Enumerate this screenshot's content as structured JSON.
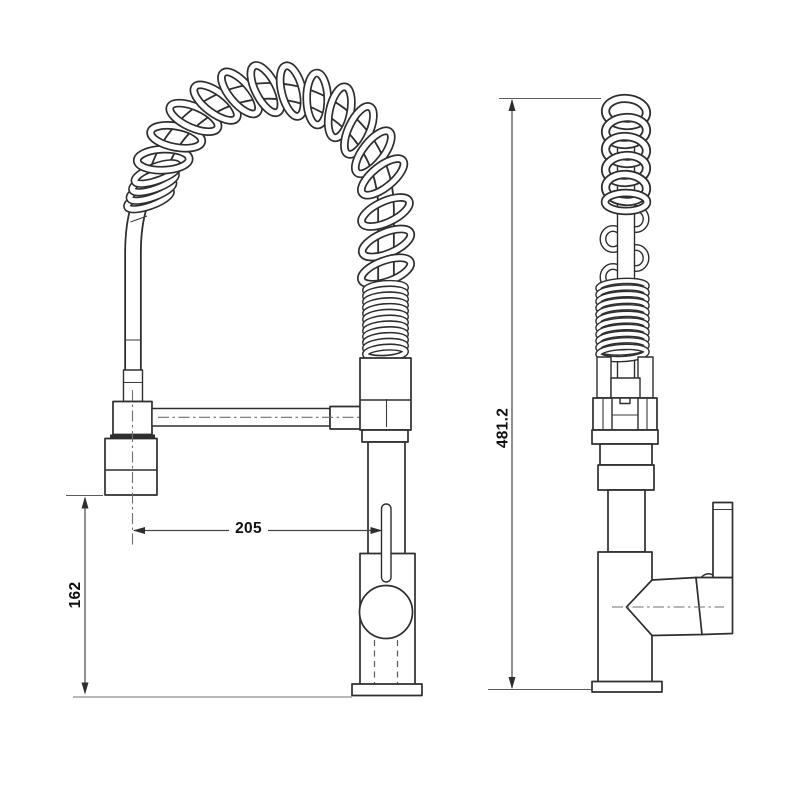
{
  "drawing": {
    "title": "faucet-technical-drawing",
    "dimensions": {
      "spout_reach": "205",
      "spray_head_height": "162",
      "total_height": "481.2"
    },
    "colors": {
      "background": "#ffffff",
      "line": "#2e2e2e",
      "dimension_line": "#474747",
      "text": "#101010",
      "baseline": "#8a9086"
    }
  }
}
